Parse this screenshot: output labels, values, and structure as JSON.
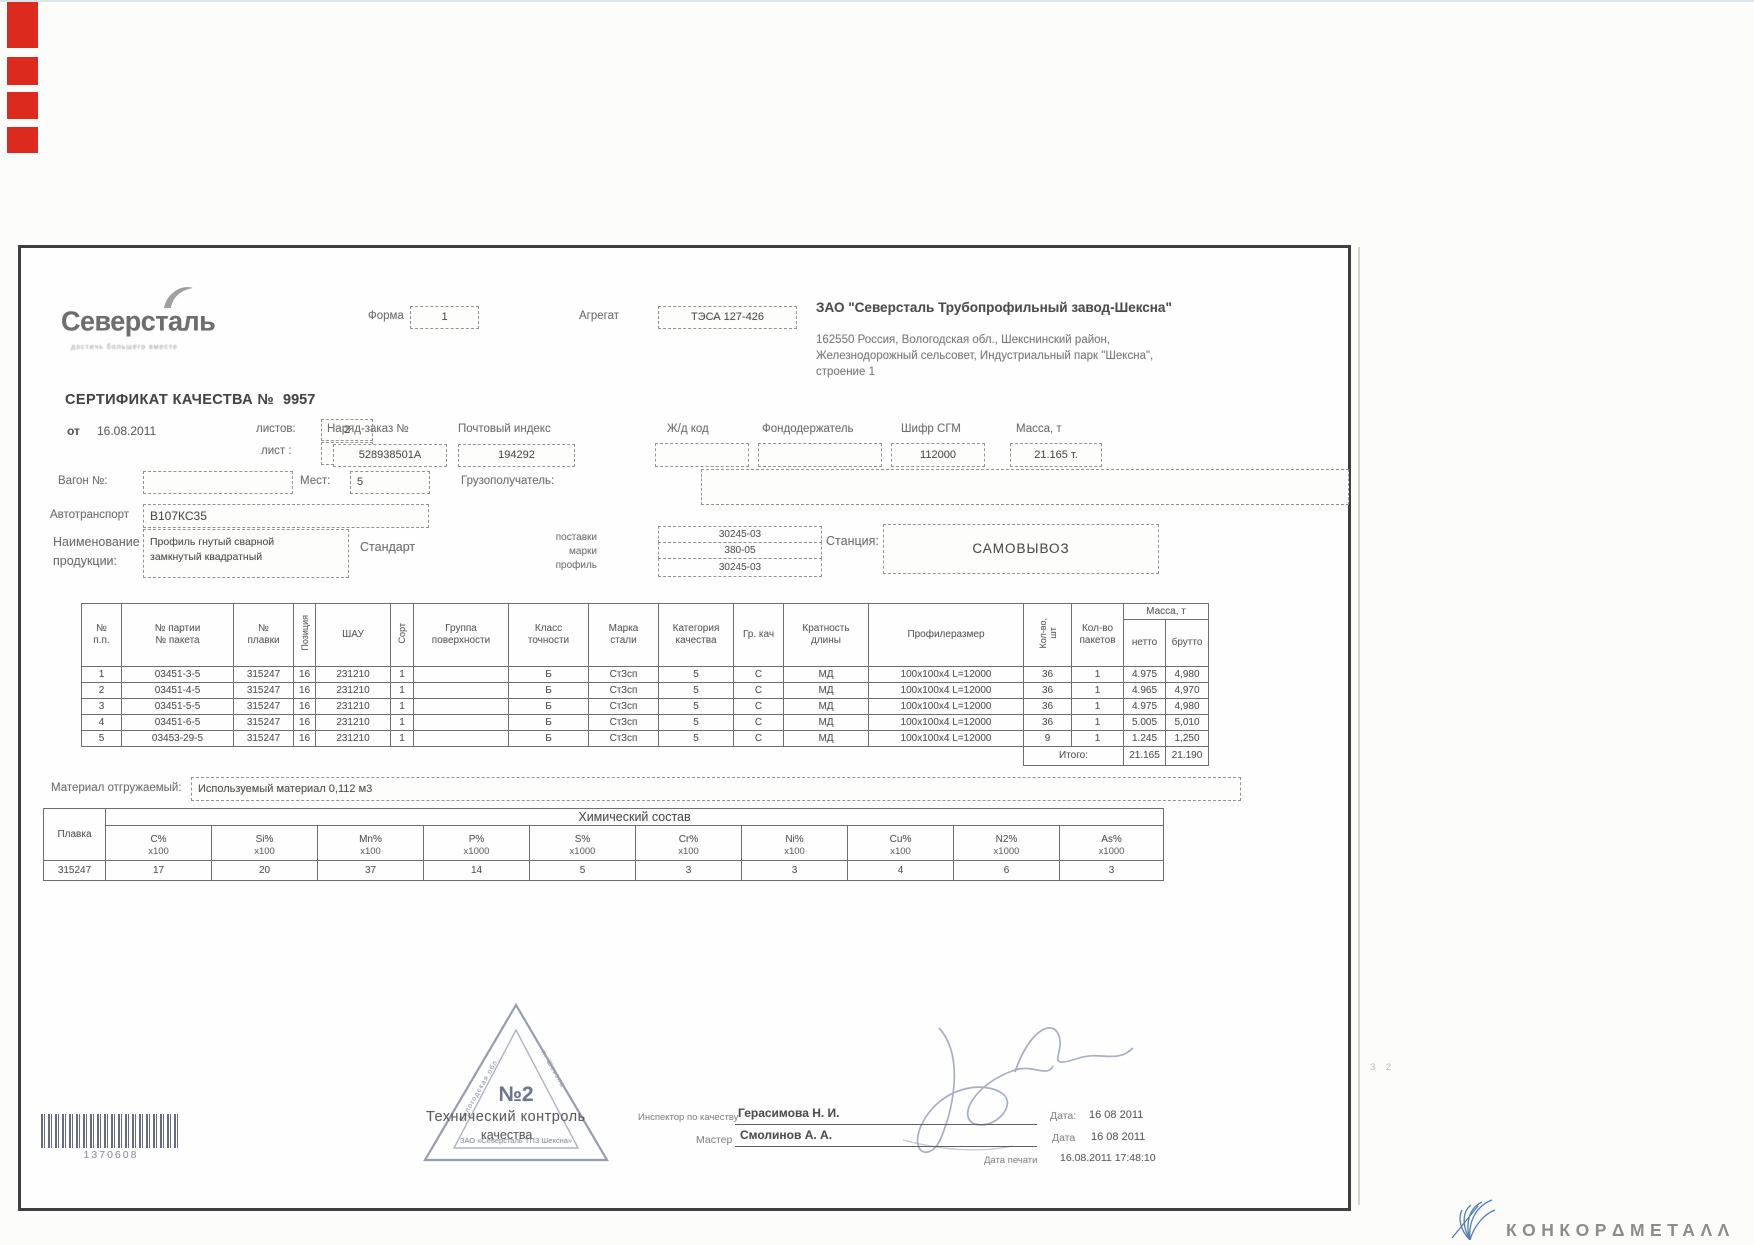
{
  "colors": {
    "scan_mark_red": "#dc2a1e",
    "stamp_ink": "#8b92a6",
    "logo_blue": "#3f6fae"
  },
  "brand": {
    "name": "Северсталь",
    "tagline": "достичь большего вместе"
  },
  "top_fields": {
    "form_label": "Форма",
    "form_value": "1",
    "aggregate_label": "Агрегат",
    "aggregate_value": "ТЭСА 127-426",
    "company_name": "ЗАО \"Северсталь Трубопрофильный завод-Шексна\"",
    "company_address": [
      "162550 Россия, Вологодская обл., Шекснинский район,",
      "Железнодорожный сельсовет, Индустриальный парк \"Шексна\",",
      "строение 1"
    ]
  },
  "certificate": {
    "title": "СЕРТИФИКАТ КАЧЕСТВА №",
    "number": "9957",
    "date_label": "от",
    "date": "16.08.2011",
    "sheets_label": "листов:",
    "sheets_value": "2",
    "sheet_label": "лист :",
    "sheet_value": "1",
    "order_label": "Наряд-заказ №",
    "order_value": "528938501А",
    "postal_label": "Почтовый индекс",
    "postal_value": "194292",
    "rail_label": "Ж/д код",
    "rail_value": "",
    "fund_label": "Фондодержатель",
    "fund_value": "",
    "cipher_label": "Шифр СГМ",
    "cipher_value": "112000",
    "mass_label": "Масса, т",
    "mass_value": "21.165 т."
  },
  "shipping": {
    "wagon_label": "Вагон №:",
    "wagon_value": "",
    "places_label": "Мест:",
    "places_value": "5",
    "consignee_label": "Грузополучатель:",
    "consignee_value": "",
    "auto_label": "Автотранспорт",
    "auto_value": "В107КС35",
    "product_label_line1": "Наименование",
    "product_label_line2": "продукции:",
    "product_value_line1": "Профиль гнутый сварной",
    "product_value_line2": "замкнутый квадратный",
    "standard_label": "Стандарт",
    "standard_rows": [
      {
        "label": "поставки",
        "value": "30245-03"
      },
      {
        "label": "марки",
        "value": "380-05"
      },
      {
        "label": "профиль",
        "value": "30245-03"
      }
    ],
    "station_label": "Станция:",
    "station_value": "САМОВЫВОЗ"
  },
  "main_table": {
    "headers": [
      "№\nп.п.",
      "№ партии\n№ пакета",
      "№\nплавки",
      "Позиция",
      "ШАУ",
      "Сорт",
      "Группа\nповерхности",
      "Класс\nточности",
      "Марка\nстали",
      "Категория\nкачества",
      "Гр. кач",
      "Кратность\nдлины",
      "Профилеразмер",
      "Кол-во,\nшт",
      "Кол-во\nпакетов",
      "Масса, т",
      "нетто",
      "брутто"
    ],
    "rows": [
      [
        "1",
        "03451-3-5",
        "315247",
        "16",
        "231210",
        "1",
        "",
        "Б",
        "Ст3сп",
        "5",
        "С",
        "МД",
        "100x100x4 L=12000",
        "36",
        "1",
        "4.975",
        "4,980"
      ],
      [
        "2",
        "03451-4-5",
        "315247",
        "16",
        "231210",
        "1",
        "",
        "Б",
        "Ст3сп",
        "5",
        "С",
        "МД",
        "100x100x4 L=12000",
        "36",
        "1",
        "4.965",
        "4,970"
      ],
      [
        "3",
        "03451-5-5",
        "315247",
        "16",
        "231210",
        "1",
        "",
        "Б",
        "Ст3сп",
        "5",
        "С",
        "МД",
        "100x100x4 L=12000",
        "36",
        "1",
        "4.975",
        "4,980"
      ],
      [
        "4",
        "03451-6-5",
        "315247",
        "16",
        "231210",
        "1",
        "",
        "Б",
        "Ст3сп",
        "5",
        "С",
        "МД",
        "100x100x4 L=12000",
        "36",
        "1",
        "5.005",
        "5,010"
      ],
      [
        "5",
        "03453-29-5",
        "315247",
        "16",
        "231210",
        "1",
        "",
        "Б",
        "Ст3сп",
        "5",
        "С",
        "МД",
        "100x100x4 L=12000",
        "9",
        "1",
        "1.245",
        "1,250"
      ]
    ],
    "total_label": "Итого:",
    "total_net": "21.165",
    "total_gross": "21.190"
  },
  "material": {
    "label": "Материал отгружаемый:",
    "value": "Используемый материал 0,112 м3"
  },
  "chem": {
    "title": "Химический состав",
    "plavka_label": "Плавка",
    "plavka_value": "315247",
    "cols": [
      {
        "el": "C%",
        "factor": "x100"
      },
      {
        "el": "Si%",
        "factor": "x100"
      },
      {
        "el": "Mn%",
        "factor": "x100"
      },
      {
        "el": "P%",
        "factor": "x1000"
      },
      {
        "el": "S%",
        "factor": "x1000"
      },
      {
        "el": "Cr%",
        "factor": "x100"
      },
      {
        "el": "Ni%",
        "factor": "x100"
      },
      {
        "el": "Cu%",
        "factor": "x100"
      },
      {
        "el": "N2%",
        "factor": "x1000"
      },
      {
        "el": "As%",
        "factor": "x1000"
      }
    ],
    "values": [
      "17",
      "20",
      "37",
      "14",
      "5",
      "3",
      "3",
      "4",
      "6",
      "3"
    ]
  },
  "stamp": {
    "number": "№2",
    "side_left": "Вологодская обл.",
    "side_right": "п. Шексна",
    "bottom": "ЗАО «Северсталь ТПЗ Шексна»",
    "printed_line1": "Технический контроль",
    "printed_line2": "качества"
  },
  "signoff": {
    "inspector_label": "Инспектор по качеству",
    "inspector_name": "Герасимова Н. И.",
    "inspector_date_label": "Дата:",
    "inspector_date": "16 08 2011",
    "master_label": "Мастер",
    "master_name": "Смолинов А. А.",
    "master_date_label": "Дата",
    "master_date": "16 08 2011",
    "print_label": "Дата печати",
    "print_value": "16.08.2011 17:48:10"
  },
  "barcode": {
    "number": "1370608"
  },
  "watermark": {
    "text": "КОНКОРΔМЕТАΛΛ"
  },
  "misc": {
    "page_mark": "3 2"
  }
}
